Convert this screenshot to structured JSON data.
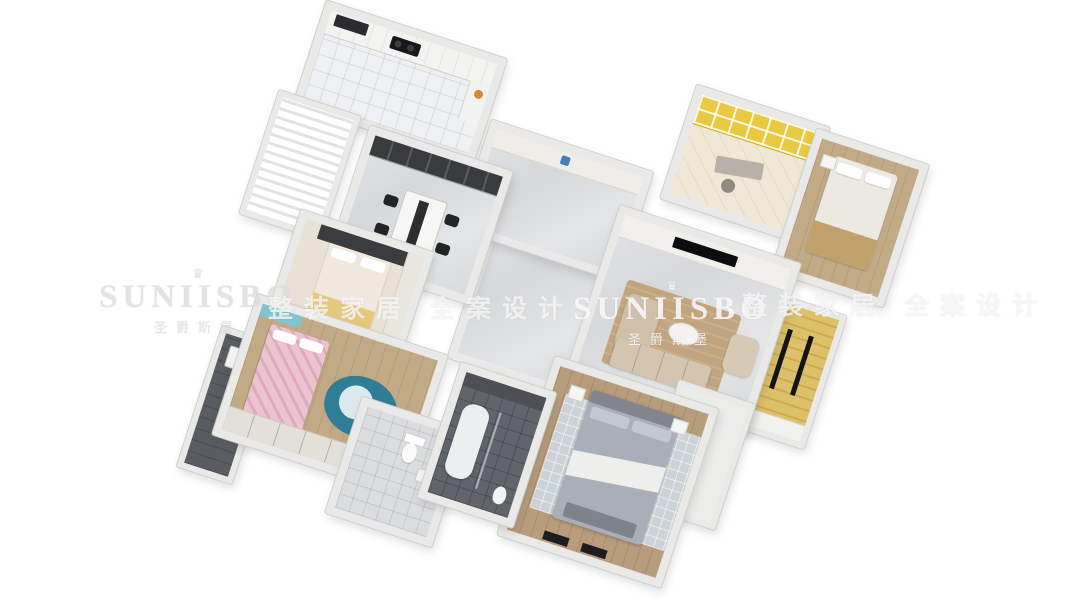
{
  "watermark": {
    "crown_icon": "♛",
    "brand": "SUNIISBO",
    "brand_cn": "圣爵斯堡",
    "tagline_left": "整装家居 全案设计",
    "tagline_right": "整装家居 全案设计"
  },
  "palette": {
    "background": "#ffffff",
    "wall": "#e9e9e7",
    "wall_edge": "#cfcfcc",
    "marble_floor": "#dcdee0",
    "wood_floor": "#c3aa87",
    "balcony_yellow_wood": "#d9ba5e",
    "study_accent_yellow": "#e8c93f",
    "sofa_beige": "#d3c5b0",
    "living_rug_tan": "#c2a57e",
    "master_bed_gray": "#a9aeb9",
    "kids_bed_pink": "#ecc3d0",
    "kids_rug_teal": "#2f7e95",
    "bath_dark_tile": "#61656b",
    "balcony_dark": "#595c60"
  },
  "scene": {
    "type": "3d-isometric-floorplan",
    "rotation_deg": 18,
    "rooms": [
      {
        "name": "kitchen",
        "floor": "white-tile"
      },
      {
        "name": "closet-balcony",
        "floor": "white-stripe"
      },
      {
        "name": "dining-room",
        "floor": "marble"
      },
      {
        "name": "foyer",
        "floor": "marble"
      },
      {
        "name": "hallway",
        "floor": "marble"
      },
      {
        "name": "study",
        "floor": "light-wood"
      },
      {
        "name": "bedroom-right",
        "floor": "wood"
      },
      {
        "name": "living-room",
        "floor": "marble"
      },
      {
        "name": "living-balcony",
        "floor": "yellow-wood"
      },
      {
        "name": "bedroom-left",
        "floor": "cream"
      },
      {
        "name": "kids-bedroom",
        "floor": "wood"
      },
      {
        "name": "kids-balcony",
        "floor": "dark"
      },
      {
        "name": "small-bathroom",
        "floor": "light-tile"
      },
      {
        "name": "master-bathroom",
        "floor": "dark-tile"
      },
      {
        "name": "master-bedroom",
        "floor": "wood"
      },
      {
        "name": "master-balcony",
        "floor": "white-tile"
      }
    ]
  }
}
